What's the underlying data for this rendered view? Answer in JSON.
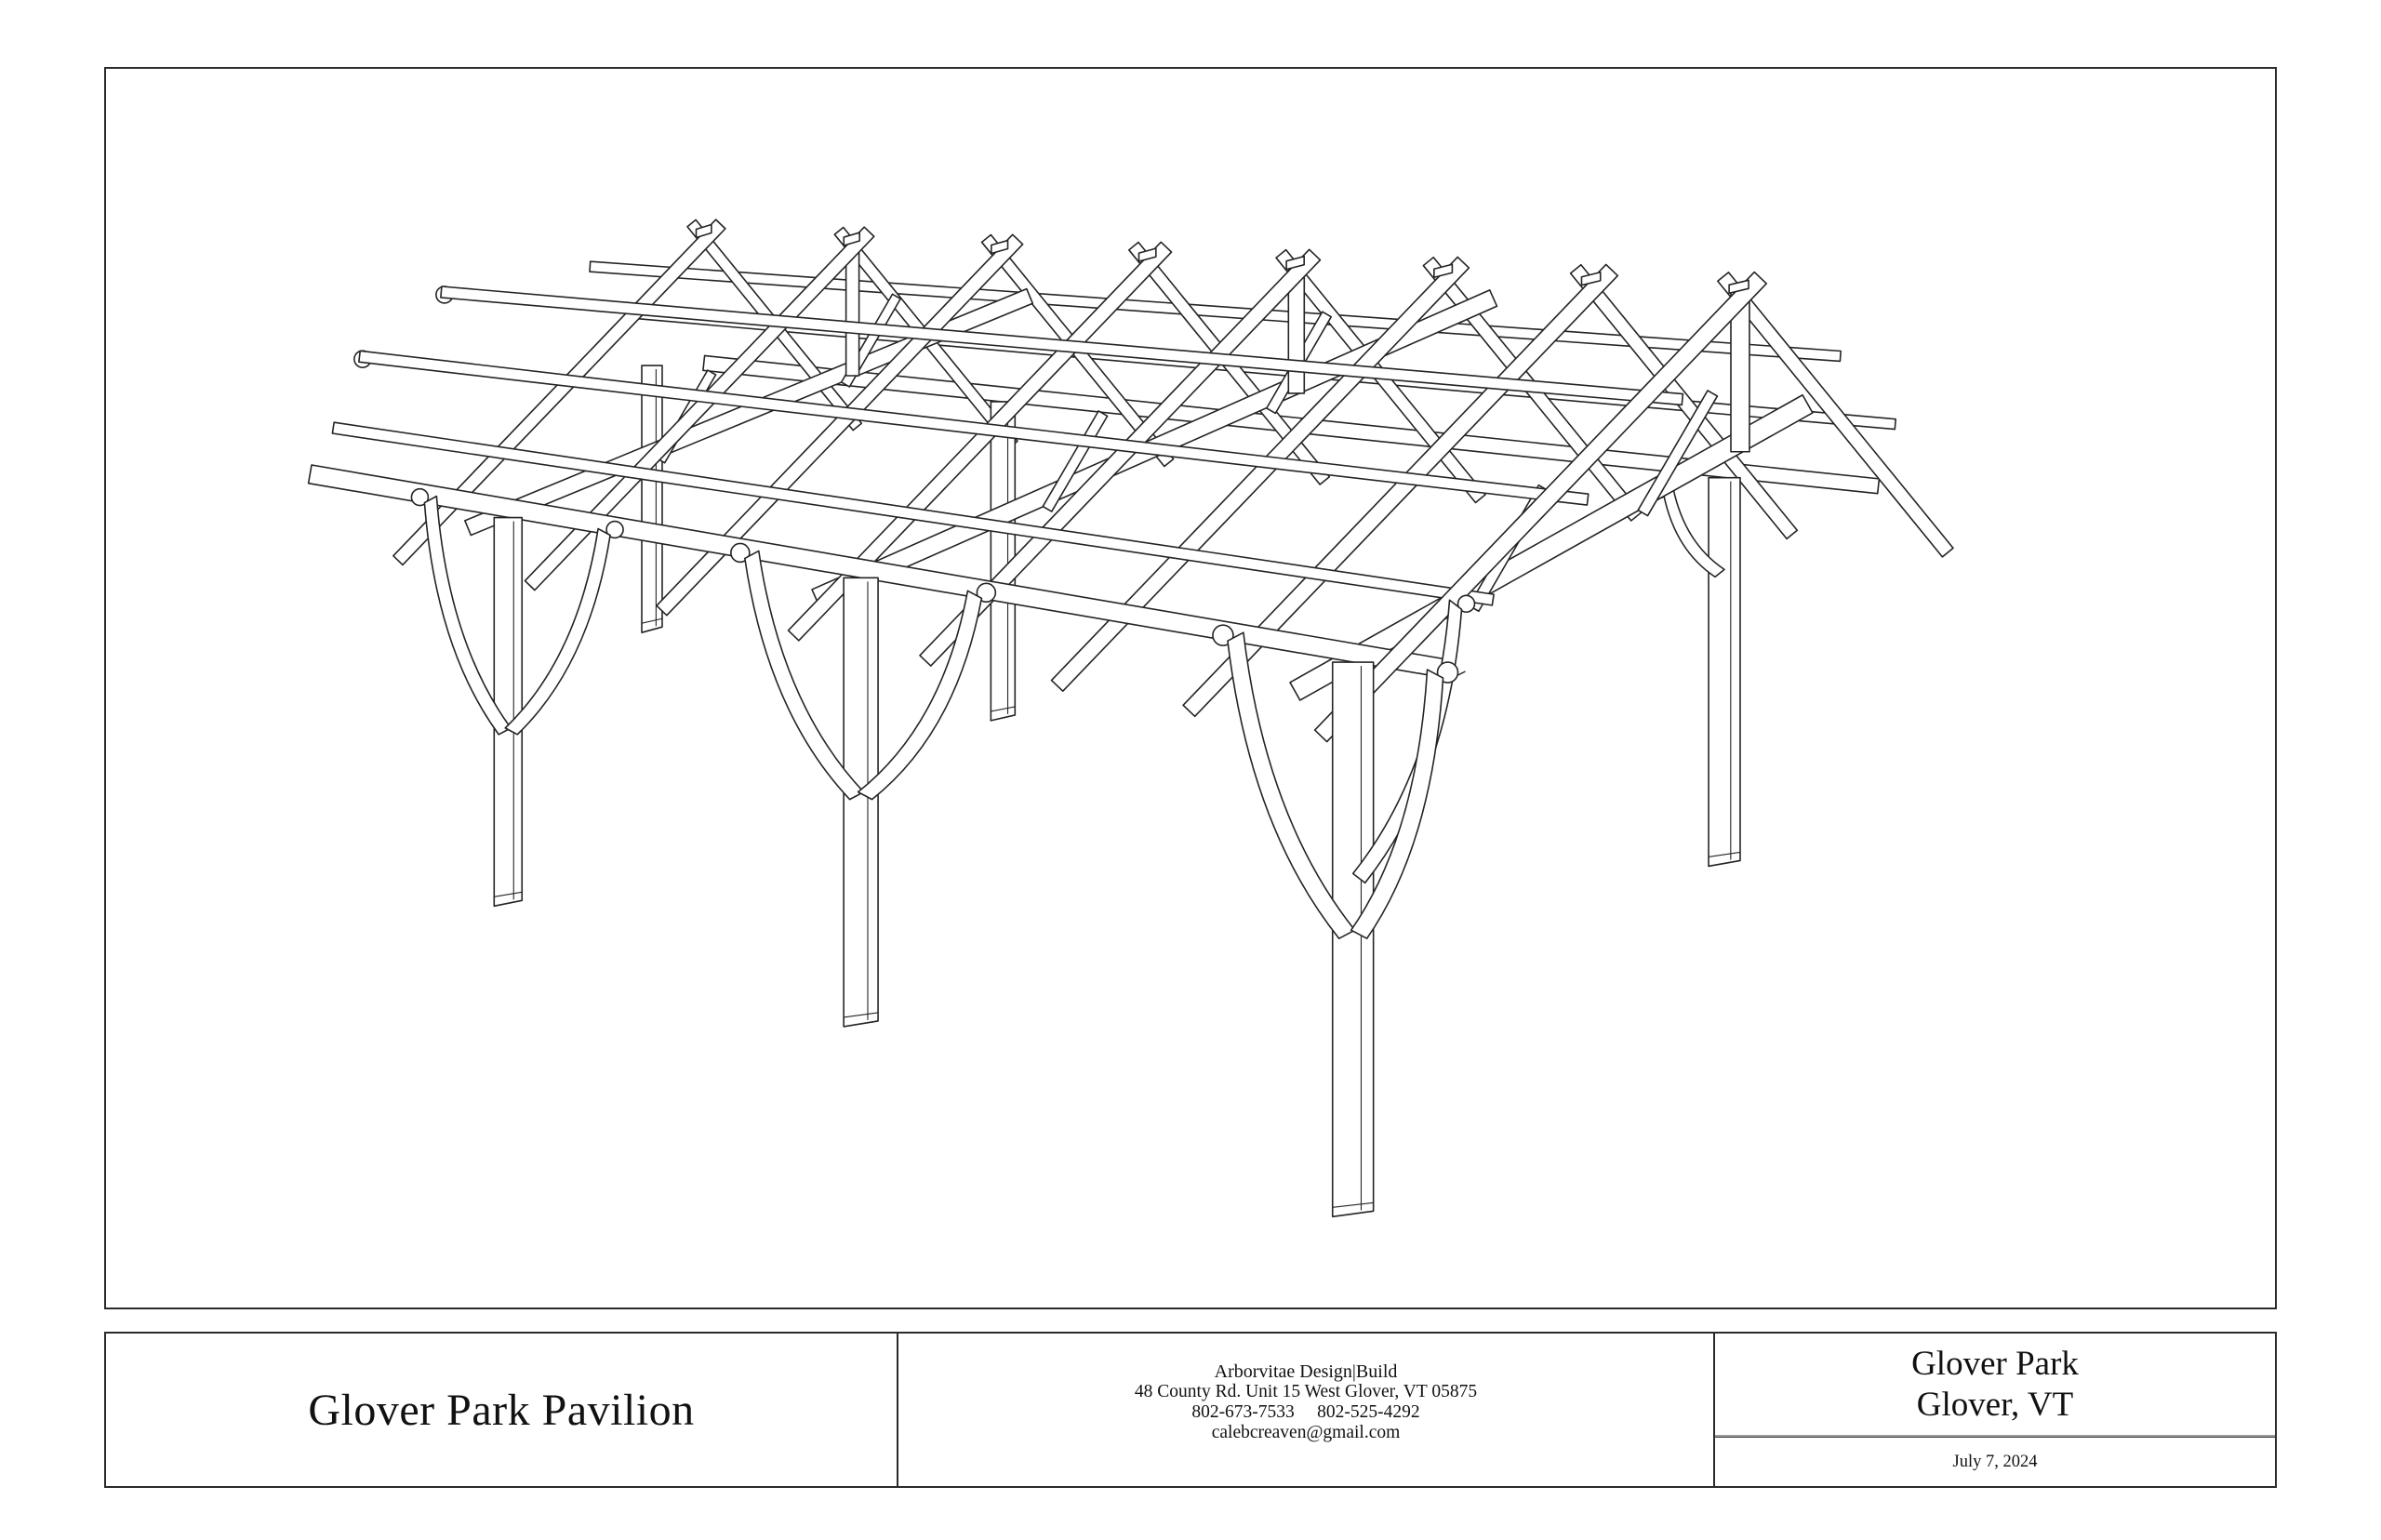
{
  "sheet": {
    "background": "#ffffff",
    "ink_color": "#242424",
    "drawing_description": "Perspective wireframe line drawing of a heavy timber frame pavilion: six posts with curved knee braces, cantilevered tie beams, eave plates, eight king-post rafter pairs with purlins and gable overhangs"
  },
  "title_block": {
    "project_title": "Glover Park Pavilion",
    "firm_name": "Arborvitae Design|Build",
    "firm_address": "48 County Rd. Unit 15 West Glover, VT 05875",
    "firm_phones": "802-673-7533     802-525-4292",
    "firm_email": "calebcreaven@gmail.com",
    "location_line1": "Glover Park",
    "location_line2": "Glover, VT",
    "date": "July 7, 2024"
  }
}
